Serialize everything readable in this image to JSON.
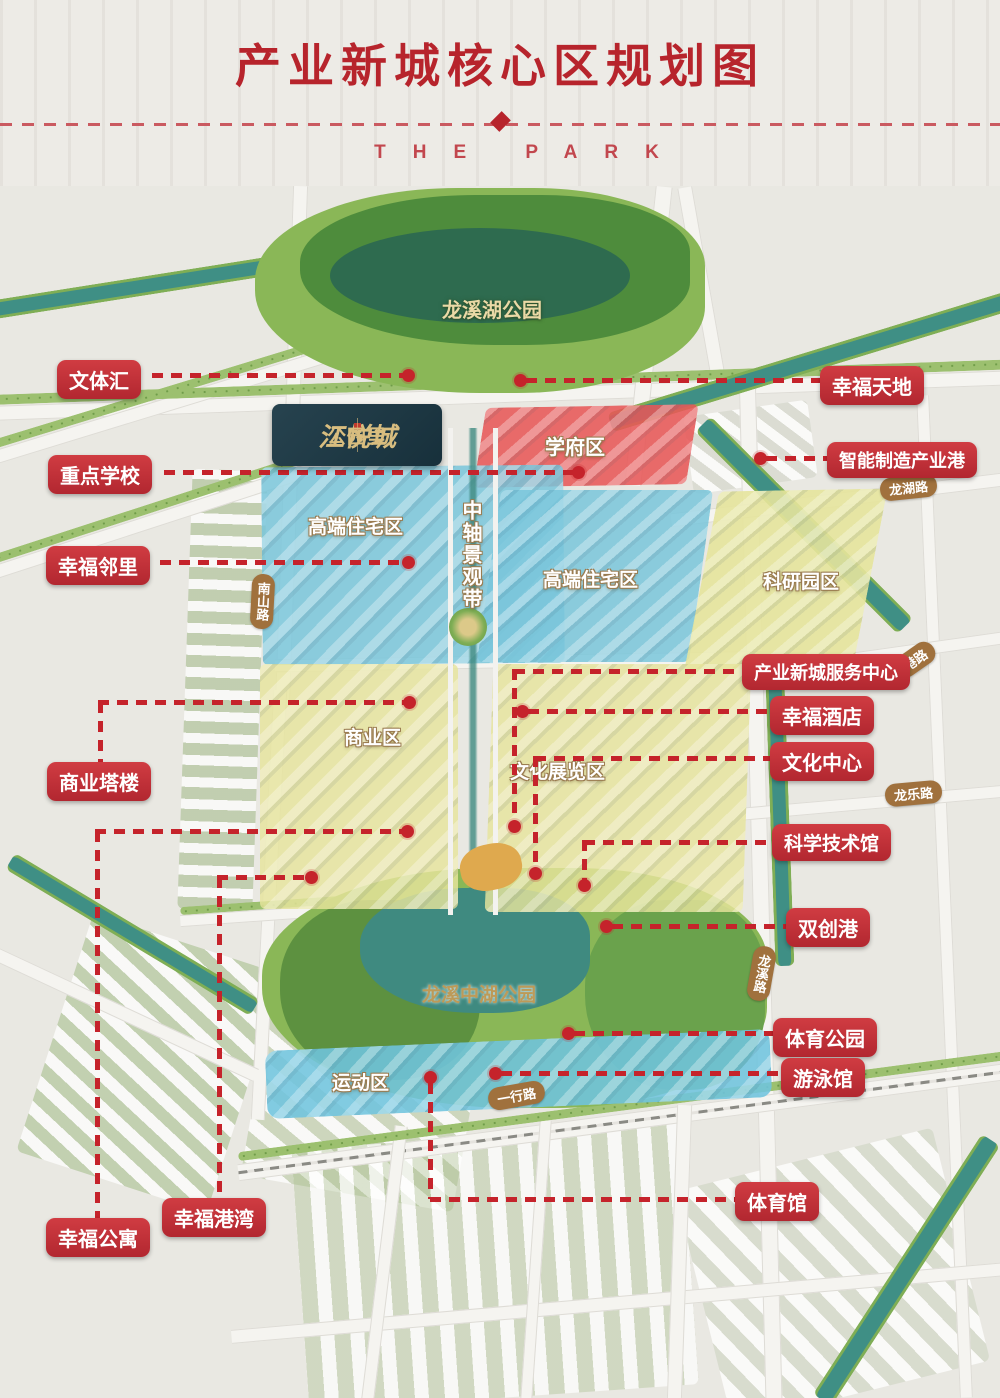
{
  "header": {
    "title": "产业新城核心区规划图",
    "subtitle": "THE PARK"
  },
  "logo": {
    "brand": "江悦城",
    "sub": "公园里"
  },
  "map": {
    "zones": [
      {
        "id": "xuefuqu",
        "label": "学府区"
      },
      {
        "id": "gaoduan-xi",
        "label": "高端住宅区"
      },
      {
        "id": "gaoduan-dong",
        "label": "高端住宅区"
      },
      {
        "id": "keyanyuanqu",
        "label": "科研园区"
      },
      {
        "id": "shangyequ",
        "label": "商业区"
      },
      {
        "id": "wenhuazhanlanqu",
        "label": "文化展览区"
      },
      {
        "id": "yundongqu",
        "label": "运动区"
      },
      {
        "id": "zhongzhou",
        "label": "中轴景观带"
      }
    ],
    "parks": [
      {
        "id": "longxihu",
        "label": "龙溪湖公园"
      },
      {
        "id": "longxizhonghu",
        "label": "龙溪中湖公园"
      }
    ],
    "roads": [
      {
        "id": "longhulu",
        "label": "龙湖路"
      },
      {
        "id": "ganglu",
        "label": "港路"
      },
      {
        "id": "longlelu",
        "label": "龙乐路"
      },
      {
        "id": "longxilu",
        "label": "龙溪路"
      },
      {
        "id": "yixinglu",
        "label": "一行路"
      },
      {
        "id": "nanshanlu",
        "label": "南山路"
      }
    ],
    "callouts": [
      {
        "id": "wentihui",
        "label": "文体汇"
      },
      {
        "id": "xingfutiandi",
        "label": "幸福天地"
      },
      {
        "id": "zhongdianxuexiao",
        "label": "重点学校"
      },
      {
        "id": "zhinenggang",
        "label": "智能制造产业港"
      },
      {
        "id": "xingfulinli",
        "label": "幸福邻里"
      },
      {
        "id": "shangyetalou",
        "label": "商业塔楼"
      },
      {
        "id": "fuwuzhongxin",
        "label": "产业新城服务中心"
      },
      {
        "id": "xingfujiudian",
        "label": "幸福酒店"
      },
      {
        "id": "wenhuazhongxin",
        "label": "文化中心"
      },
      {
        "id": "kexuejishuguan",
        "label": "科学技术馆"
      },
      {
        "id": "shuangchuanggang",
        "label": "双创港"
      },
      {
        "id": "tiyugongyuan",
        "label": "体育公园"
      },
      {
        "id": "youyongguan",
        "label": "游泳馆"
      },
      {
        "id": "xingfugongyu",
        "label": "幸福公寓"
      },
      {
        "id": "xingfugangwan",
        "label": "幸福港湾"
      },
      {
        "id": "tiyuguan",
        "label": "体育馆"
      }
    ]
  },
  "colors": {
    "title_red": "#b7242c",
    "callout_red": "#c5232b",
    "zone_blue": "#79c5da",
    "zone_yellow": "#e6e49c",
    "zone_red": "#e75858",
    "park_green": "#5d9344",
    "water_teal": "#3f8f85",
    "road_pill_brown": "#a0713d",
    "logo_navy": "#1d3742",
    "logo_gold": "#d8bd7f"
  }
}
